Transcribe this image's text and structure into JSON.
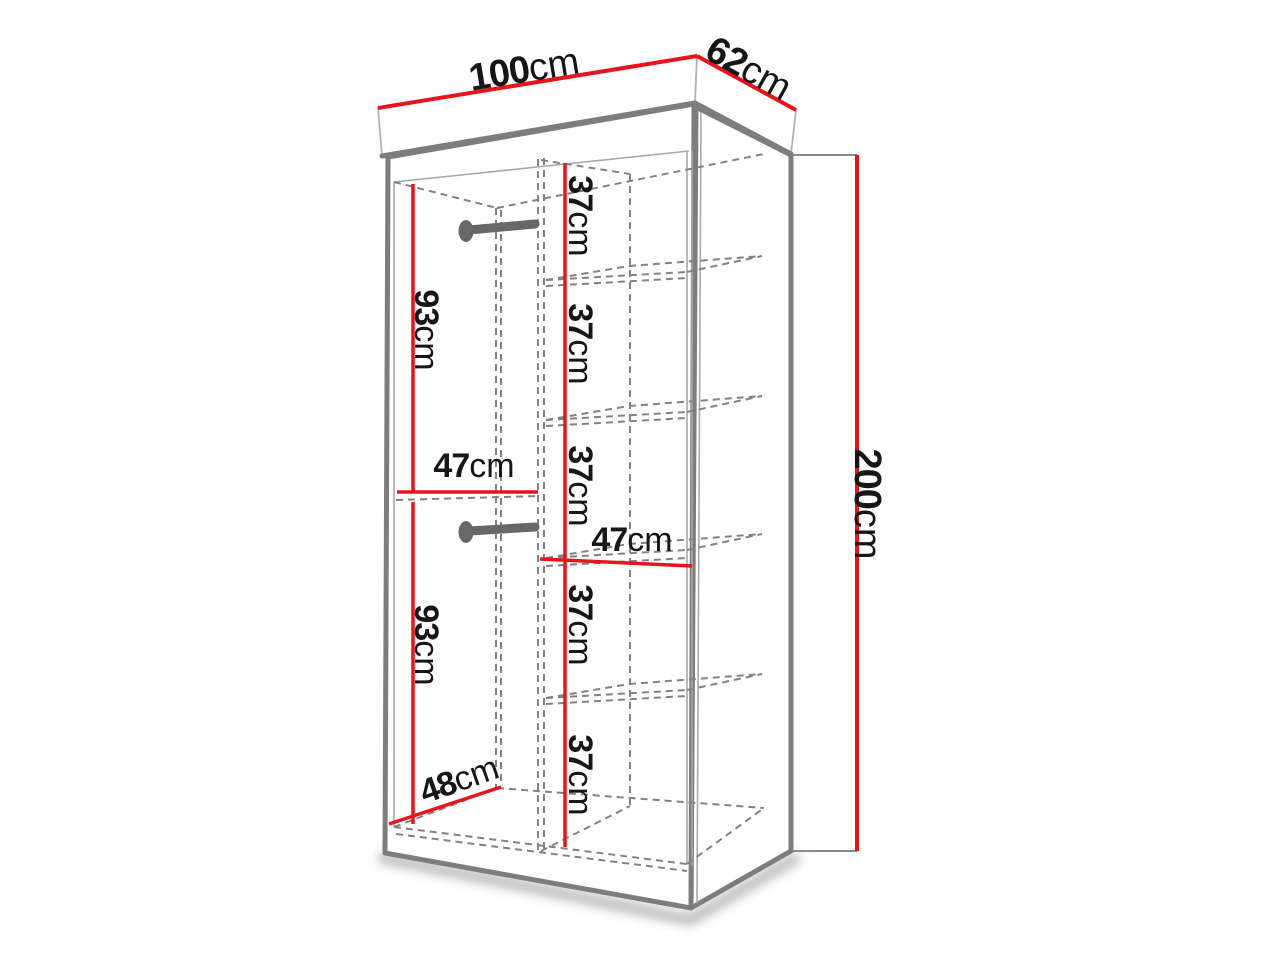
{
  "diagram": {
    "subject": "wardrobe-dimension-diagram",
    "labels": {
      "top_width": {
        "value": "100",
        "unit": "cm"
      },
      "top_depth": {
        "value": "62",
        "unit": "cm"
      },
      "right_height": {
        "value": "200",
        "unit": "cm"
      },
      "left_upper_hang": {
        "value": "93",
        "unit": "cm"
      },
      "left_upper_width": {
        "value": "47",
        "unit": "cm"
      },
      "left_lower_hang": {
        "value": "93",
        "unit": "cm"
      },
      "mid_shelf_width": {
        "value": "47",
        "unit": "cm"
      },
      "bottom_depth": {
        "value": "48",
        "unit": "cm"
      },
      "shelves": [
        {
          "value": "37",
          "unit": "cm"
        },
        {
          "value": "37",
          "unit": "cm"
        },
        {
          "value": "37",
          "unit": "cm"
        },
        {
          "value": "37",
          "unit": "cm"
        },
        {
          "value": "37",
          "unit": "cm"
        }
      ]
    },
    "colors": {
      "dimension_red": "#e8141c",
      "outline_gray": "#7d7d7d",
      "dash_gray": "#828282",
      "rod_gray": "#676767",
      "text_black": "#161616",
      "background": "#ffffff"
    }
  }
}
